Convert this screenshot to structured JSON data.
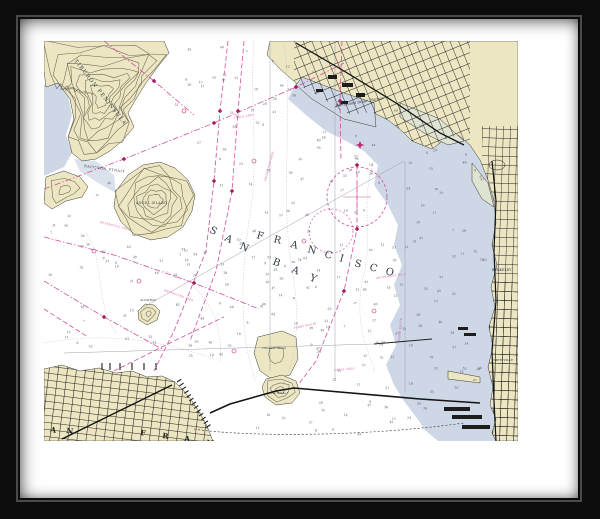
{
  "artwork": {
    "name": "Framed nautical chart print",
    "frame_color": "#0c0c0c",
    "mat_color": "#ffffff"
  },
  "chart": {
    "bay_word1": "SAN",
    "bay_word2": "FRANCISCO",
    "bay_word3": "BAY",
    "city_label": "SAN FRANCISCO",
    "labels": {
      "tiburon": "TIBURON PENINSULA",
      "raccoon_strait": "RACCOON STRAIT",
      "angel_island": "ANGEL ISLAND",
      "alcatraz": "ALCATRAZ",
      "richmond_harbor": "Richmond Inner Harbor",
      "berkeley": "BERKELEY",
      "emeryville": "EMERYVILLE",
      "treasure_island": "Treasure Island",
      "yerba_buena": "Yerba Buena I"
    },
    "magenta_notes": [
      "CABLE AREA",
      "PROHIBITED AREA",
      "RESTRICTED AREA",
      "FERRY ROUTE",
      "ANCHORAGE NO 5",
      "CABLE AREA",
      "RESTRICTED AREA",
      "FERRY ROUTE"
    ],
    "colors": {
      "land_tan": "#ece6c3",
      "water_blue": "#cdd7e6",
      "marsh": "#dfe3d2",
      "magenta": "#d0509a",
      "magenta_dark": "#a81d60",
      "contour": "#6b6552",
      "street": "#1d1d1b",
      "depth_curve": "#b6c0d0"
    },
    "soundings": [
      23,
      31,
      12,
      8,
      41,
      36,
      7,
      54,
      18,
      26,
      9,
      33,
      47,
      15,
      62,
      21,
      38,
      11,
      29,
      44,
      17,
      35,
      6,
      58,
      24,
      13,
      49,
      28,
      40,
      10,
      32,
      52,
      19,
      37,
      25,
      14,
      46,
      30,
      8,
      57
    ]
  }
}
